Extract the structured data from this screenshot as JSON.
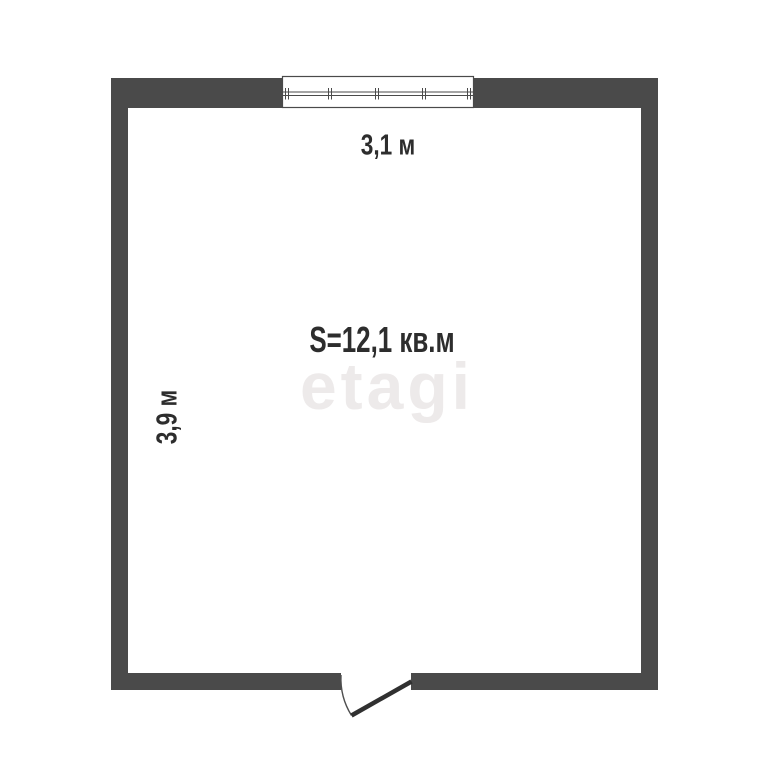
{
  "floor_plan": {
    "room": {
      "area_label": "S=12,1 кв.м",
      "top_dimension": "3,1 м",
      "left_dimension": "3,9 м"
    },
    "watermark": "etagi"
  },
  "colors": {
    "wall": "#4a4a4a",
    "text": "#2d2d2d",
    "door_leaf": "#303030",
    "arc": "#4f4f4f",
    "watermark": "#edeaea",
    "background": "#ffffff"
  }
}
